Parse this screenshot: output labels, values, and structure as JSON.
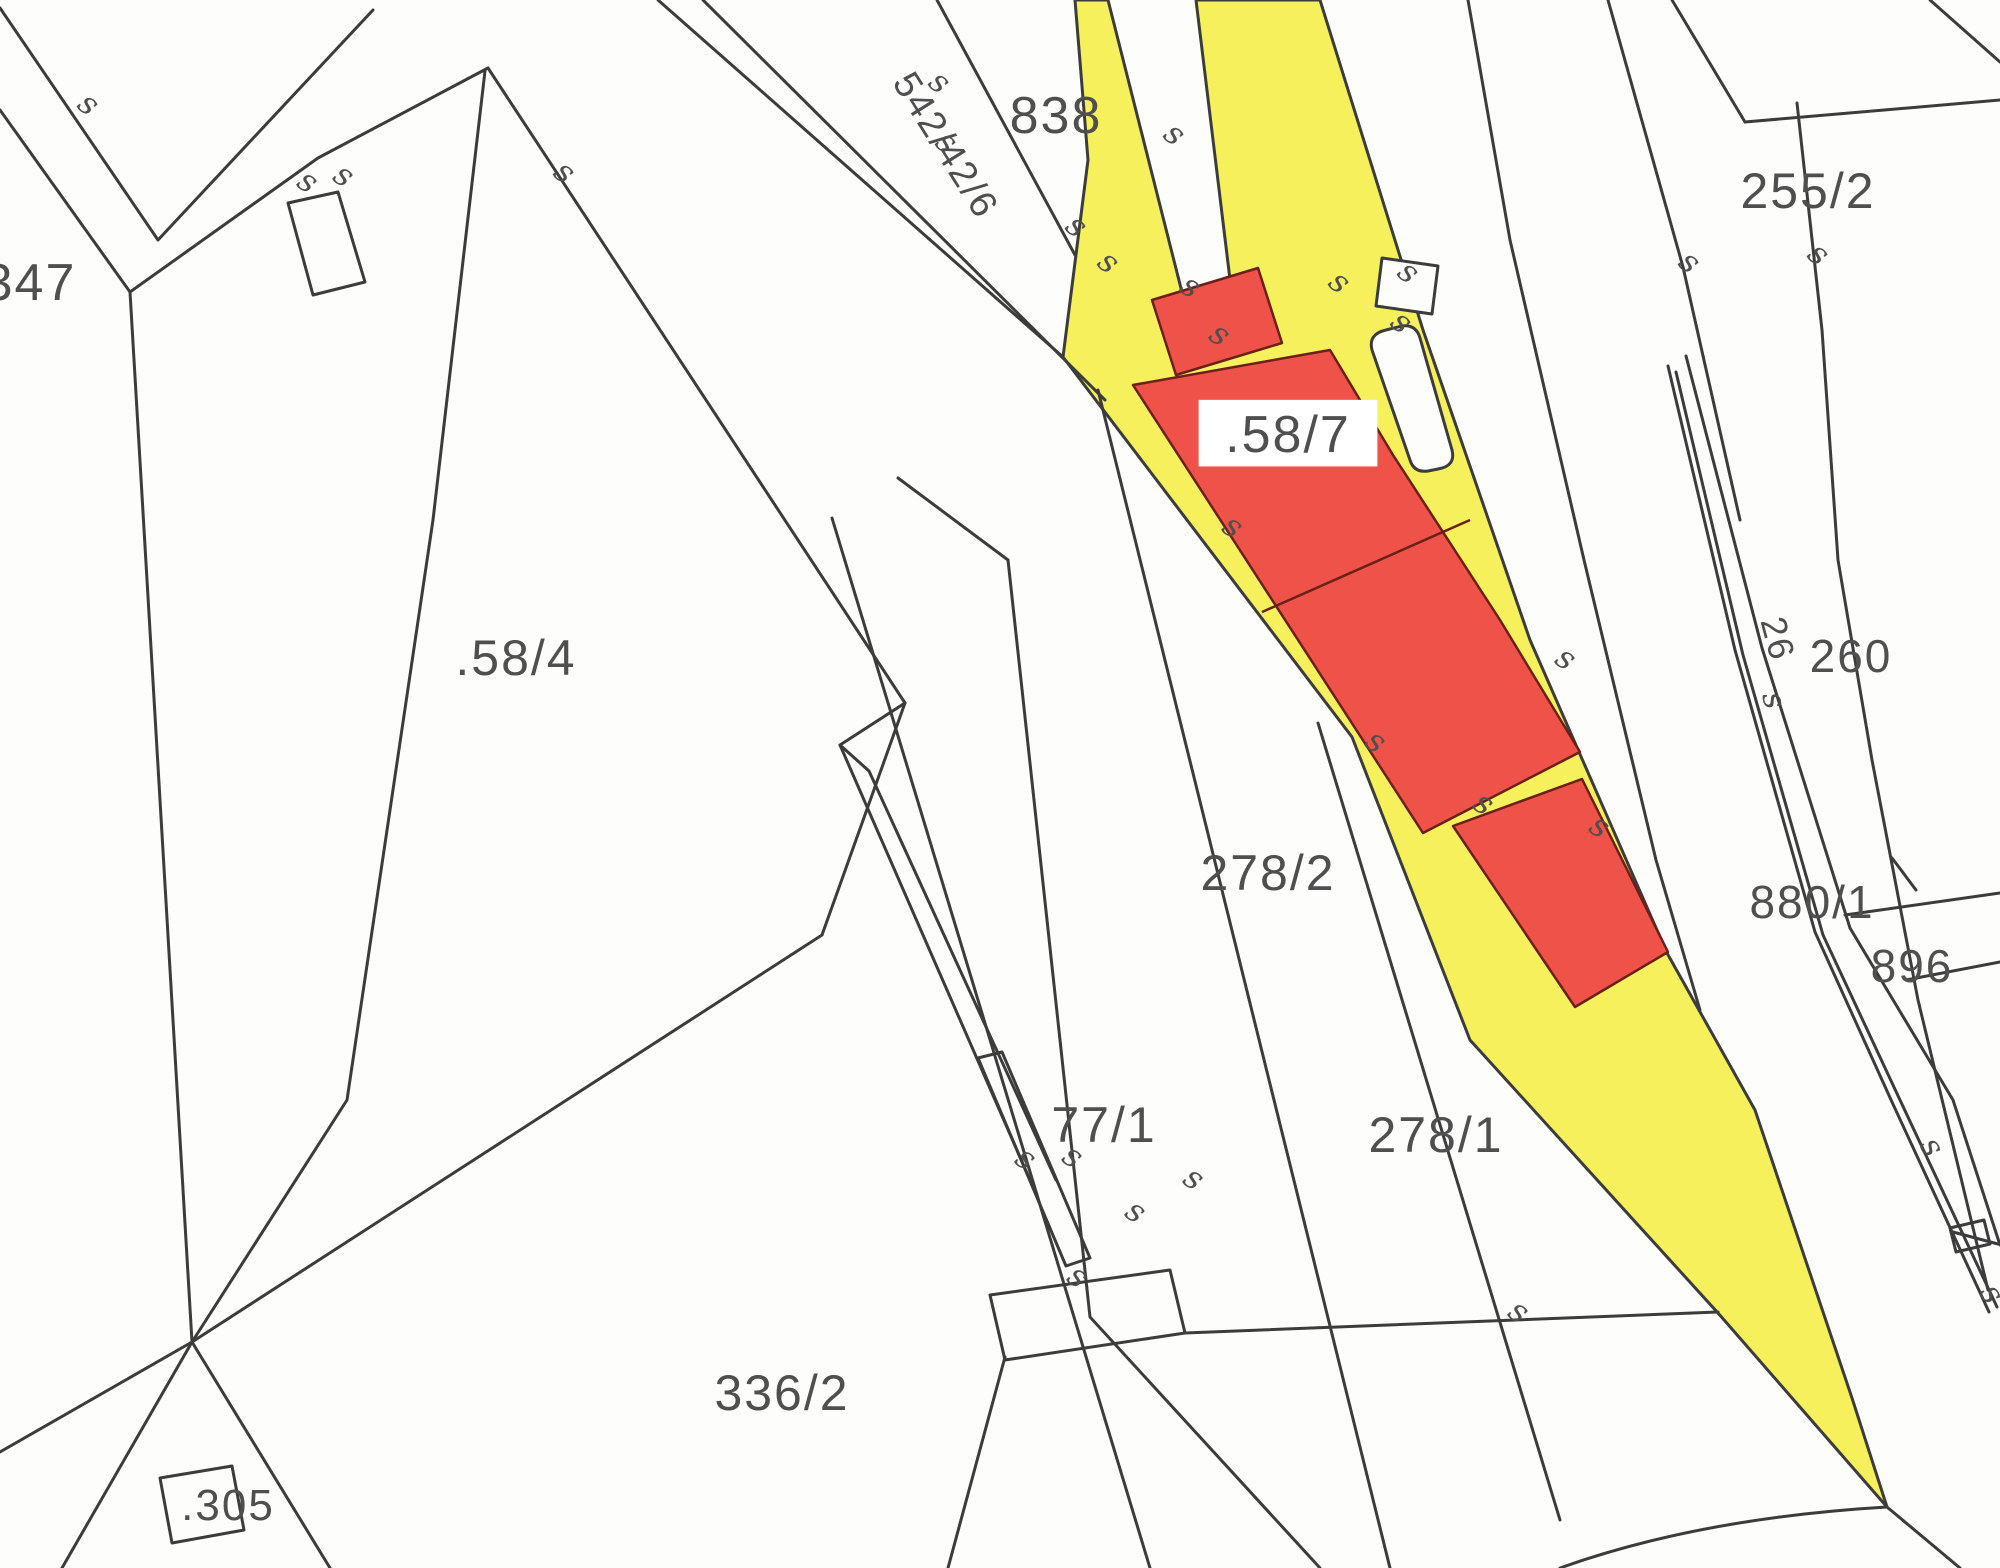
{
  "map": {
    "type": "cadastral-parcel-map",
    "colors": {
      "highlighted_parcel": "#f5f05c",
      "building": "#ee5248",
      "building_outline": "#6b2019",
      "boundary_line": "#3c3c3c",
      "label_text": "#4f4f4f",
      "label_box": "#ffffff",
      "background": "#fdfdfc"
    },
    "highlighted_parcel_label": ".58/7",
    "labels": [
      {
        "id": "parcel-347",
        "text": "347",
        "x": 30,
        "y": 300,
        "size": 52,
        "rotate": 0,
        "boxed": false
      },
      {
        "id": "road-542-42-6",
        "text": "542/42/6",
        "x": 935,
        "y": 152,
        "size": 38,
        "rotate": 58,
        "boxed": false
      },
      {
        "id": "road-838",
        "text": "838",
        "x": 1056,
        "y": 133,
        "size": 52,
        "rotate": 0,
        "boxed": false
      },
      {
        "id": "parcel-255-2",
        "text": "255/2",
        "x": 1808,
        "y": 208,
        "size": 50,
        "rotate": 0,
        "boxed": false
      },
      {
        "id": "parcel-58-7",
        "text": ".58/7",
        "x": 1288,
        "y": 452,
        "size": 52,
        "rotate": 0,
        "boxed": true
      },
      {
        "id": "parcel-58-4",
        "text": ".58/4",
        "x": 516,
        "y": 675,
        "size": 50,
        "rotate": 0,
        "boxed": false
      },
      {
        "id": "railway-26",
        "text": "26",
        "x": 1766,
        "y": 642,
        "size": 36,
        "rotate": 75,
        "boxed": false
      },
      {
        "id": "parcel-260",
        "text": "260",
        "x": 1851,
        "y": 672,
        "size": 46,
        "rotate": 0,
        "boxed": false
      },
      {
        "id": "parcel-278-2",
        "text": "278/2",
        "x": 1268,
        "y": 890,
        "size": 50,
        "rotate": 0,
        "boxed": false
      },
      {
        "id": "parcel-880-1",
        "text": "880/1",
        "x": 1812,
        "y": 918,
        "size": 46,
        "rotate": 0,
        "boxed": false
      },
      {
        "id": "parcel-896",
        "text": "896",
        "x": 1912,
        "y": 982,
        "size": 46,
        "rotate": 0,
        "boxed": false
      },
      {
        "id": "parcel-77-1",
        "text": "77/1",
        "x": 1104,
        "y": 1142,
        "size": 50,
        "rotate": 0,
        "boxed": false
      },
      {
        "id": "parcel-278-1",
        "text": "278/1",
        "x": 1436,
        "y": 1152,
        "size": 50,
        "rotate": 0,
        "boxed": false
      },
      {
        "id": "parcel-336-2",
        "text": "336/2",
        "x": 782,
        "y": 1410,
        "size": 50,
        "rotate": 0,
        "boxed": false
      },
      {
        "id": "parcel-305",
        "text": ".305",
        "x": 228,
        "y": 1520,
        "size": 44,
        "rotate": 0,
        "boxed": false
      }
    ],
    "boundary_marker": {
      "glyph": "s",
      "size": 32,
      "positions": [
        [
          82,
          112,
          40
        ],
        [
          302,
          190,
          35
        ],
        [
          338,
          184,
          35
        ],
        [
          558,
          180,
          40
        ],
        [
          933,
          90,
          40
        ],
        [
          940,
          150,
          40
        ],
        [
          1168,
          142,
          40
        ],
        [
          1070,
          234,
          40
        ],
        [
          1102,
          270,
          40
        ],
        [
          1185,
          295,
          35
        ],
        [
          1214,
          343,
          35
        ],
        [
          1333,
          290,
          40
        ],
        [
          1402,
          280,
          40
        ],
        [
          1395,
          330,
          40
        ],
        [
          1683,
          270,
          40
        ],
        [
          1812,
          262,
          40
        ],
        [
          1227,
          535,
          35
        ],
        [
          1370,
          750,
          35
        ],
        [
          1478,
          812,
          35
        ],
        [
          1560,
          667,
          35
        ],
        [
          1594,
          835,
          35
        ],
        [
          1764,
          703,
          75
        ],
        [
          1020,
          1167,
          35
        ],
        [
          1067,
          1165,
          35
        ],
        [
          1130,
          1220,
          35
        ],
        [
          1188,
          1187,
          35
        ],
        [
          1072,
          1285,
          35
        ],
        [
          1513,
          1320,
          35
        ],
        [
          1923,
          1152,
          60
        ],
        [
          1983,
          1299,
          60
        ]
      ]
    }
  }
}
